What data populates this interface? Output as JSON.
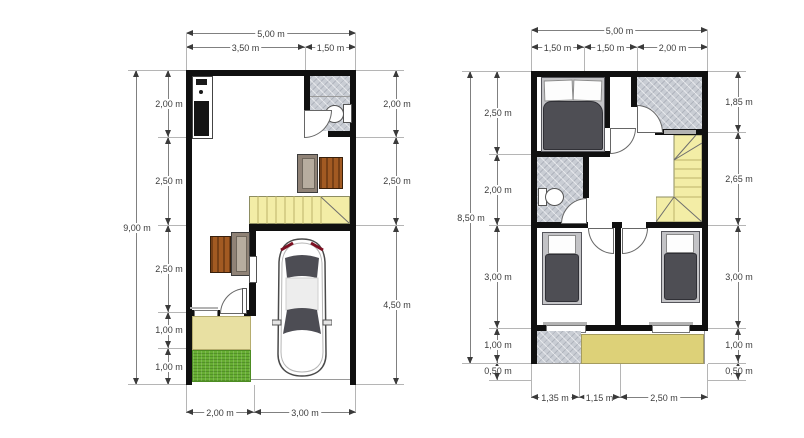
{
  "ground_floor": {
    "dim_top_total": "5,00 m",
    "dim_top_segments": [
      "3,50 m",
      "1,50 m"
    ],
    "dim_left_total": "9,00 m",
    "dim_left_segments": [
      "2,00 m",
      "2,50 m",
      "2,50 m",
      "1,00 m",
      "1,00 m"
    ],
    "dim_right_segments": [
      "2,00 m",
      "2,50 m",
      "4,50 m"
    ],
    "dim_bottom_segments": [
      "2,00 m",
      "3,00 m"
    ]
  },
  "upper_floor": {
    "dim_top_total": "5,00 m",
    "dim_top_segments": [
      "1,50 m",
      "1,50 m",
      "2,00 m"
    ],
    "dim_left_total": "8,50 m",
    "dim_left_segments": [
      "2,50 m",
      "2,00 m",
      "3,00 m",
      "1,00 m",
      "0,50 m"
    ],
    "dim_right_segments": [
      "1,85 m",
      "2,65 m",
      "3,00 m",
      "1,00 m",
      "0,50 m"
    ],
    "dim_bottom_segments": [
      "1,35 m",
      "1,15 m",
      "2,50 m"
    ]
  },
  "colors": {
    "wall": "#101010",
    "stairs_fill": "#f3eda6",
    "porch_fill": "#e8e0a2",
    "balcony_fill": "#ddd178",
    "grass_fill": "#67ae33",
    "tile_fill": "#c9cdd4",
    "wood_fill": "#a25a22",
    "sofa_fill": "#8f8276",
    "bed_fill": "#4e4e54"
  }
}
